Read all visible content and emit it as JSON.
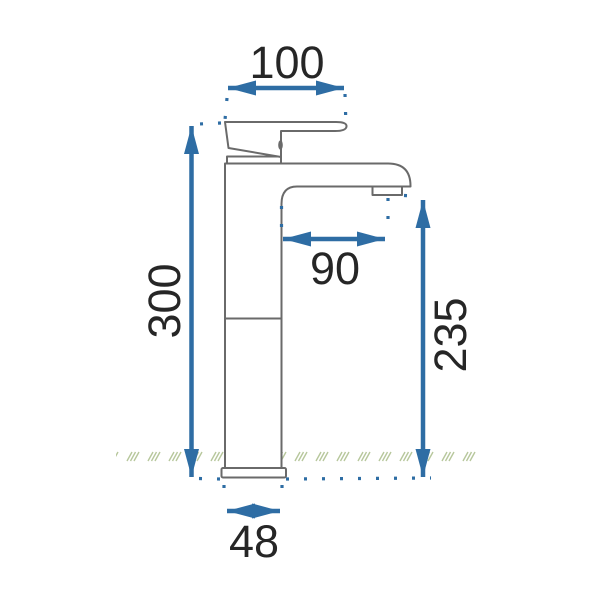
{
  "page": {
    "background": "#ffffff"
  },
  "drawing": {
    "subject": "tall-single-lever-basin-mixer-tap-side-view",
    "units": "mm",
    "dimensions": {
      "top_width": "100",
      "total_height": "300",
      "spout_reach": "90",
      "spout_outlet_height": "235",
      "base_width": "48"
    },
    "colors": {
      "dimension_accent": "#2e6da4",
      "outline": "#6a6a6a",
      "label_text": "#262626",
      "ground_hatch": "#b7c79c",
      "background": "#ffffff"
    }
  }
}
